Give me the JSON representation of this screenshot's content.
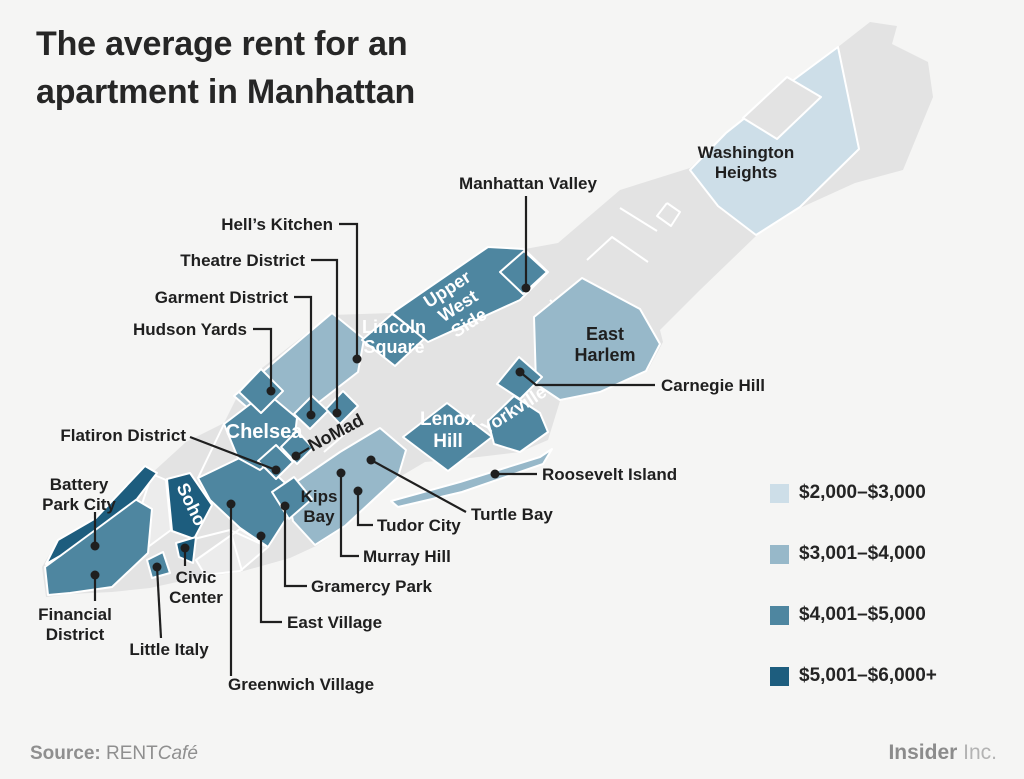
{
  "title": "The average rent for an apartment in Manhattan",
  "legend": {
    "items": [
      {
        "label": "$2,000–$3,000",
        "color": "#cddee8"
      },
      {
        "label": "$3,001–$4,000",
        "color": "#97b8c9"
      },
      {
        "label": "$4,001–$5,000",
        "color": "#4e86a0"
      },
      {
        "label": "$5,001–$6,000+",
        "color": "#1d5d7e"
      }
    ]
  },
  "map": {
    "colors": {
      "background": "#f5f5f4",
      "base_gray": "#e3e3e3",
      "light_gray": "#ececec",
      "border": "#ffffff",
      "callout": "#1f1f1f"
    },
    "regions": [
      {
        "id": "washington-heights",
        "tier": 0
      },
      {
        "id": "hells-kitchen-band",
        "tier": 1
      },
      {
        "id": "east-side-band",
        "tier": 1
      },
      {
        "id": "east-harlem",
        "tier": 1
      },
      {
        "id": "roosevelt-island",
        "tier": 1
      },
      {
        "id": "financial-district",
        "tier": 2
      },
      {
        "id": "village-band",
        "tier": 2
      },
      {
        "id": "gramercy",
        "tier": 2
      },
      {
        "id": "little-italy",
        "tier": 2
      },
      {
        "id": "chelsea",
        "tier": 2
      },
      {
        "id": "hudson-yards",
        "tier": 2
      },
      {
        "id": "garment",
        "tier": 2
      },
      {
        "id": "theatre",
        "tier": 2
      },
      {
        "id": "flatiron",
        "tier": 2
      },
      {
        "id": "nomad",
        "tier": 2
      },
      {
        "id": "lincoln-square",
        "tier": 2
      },
      {
        "id": "uws-band",
        "tier": 2
      },
      {
        "id": "manhattan-valley",
        "tier": 2
      },
      {
        "id": "lenox-hill",
        "tier": 2
      },
      {
        "id": "yorkville",
        "tier": 2
      },
      {
        "id": "carnegie-hill",
        "tier": 2
      },
      {
        "id": "battery-park-city",
        "tier": 3
      },
      {
        "id": "soho",
        "tier": 3
      },
      {
        "id": "civic-center",
        "tier": 3
      }
    ],
    "labels": [
      {
        "id": "manhattan-valley",
        "label": "Manhattan Valley"
      },
      {
        "id": "hells-kitchen",
        "label": "Hell’s Kitchen"
      },
      {
        "id": "theatre-district",
        "label": "Theatre District"
      },
      {
        "id": "garment-district",
        "label": "Garment District"
      },
      {
        "id": "hudson-yards",
        "label": "Hudson Yards"
      },
      {
        "id": "carnegie-hill",
        "label": "Carnegie Hill"
      },
      {
        "id": "flatiron-district",
        "label": "Flatiron District"
      },
      {
        "id": "battery-park-city",
        "label": "Battery Park City"
      },
      {
        "id": "financial-district",
        "label": "Financial District"
      },
      {
        "id": "civic-center",
        "label": "Civic Center"
      },
      {
        "id": "little-italy",
        "label": "Little Italy"
      },
      {
        "id": "greenwich-village",
        "label": "Greenwich Village"
      },
      {
        "id": "east-village",
        "label": "East Village"
      },
      {
        "id": "gramercy-park",
        "label": "Gramercy Park"
      },
      {
        "id": "murray-hill",
        "label": "Murray Hill"
      },
      {
        "id": "tudor-city",
        "label": "Tudor City"
      },
      {
        "id": "turtle-bay",
        "label": "Turtle Bay"
      },
      {
        "id": "roosevelt-island",
        "label": "Roosevelt Island"
      },
      {
        "id": "washington-heights",
        "label": "Washington Heights"
      },
      {
        "id": "east-harlem",
        "label": "East Harlem"
      },
      {
        "id": "kips-bay",
        "label": "Kips Bay"
      },
      {
        "id": "nomad",
        "label": "NoMad"
      },
      {
        "id": "chelsea",
        "label": "Chelsea"
      },
      {
        "id": "lincoln-square",
        "label": "Lincoln Square"
      },
      {
        "id": "upper-west-side",
        "label": "Upper West Side"
      },
      {
        "id": "lenox-hill",
        "label": "Lenox Hill"
      },
      {
        "id": "yorkville",
        "label": "Yorkville"
      },
      {
        "id": "soho",
        "label": "Soho"
      }
    ]
  },
  "footer": {
    "source_prefix": "Source:",
    "source_name": "RENT",
    "source_name_italic": "Café",
    "brand": "Insider",
    "brand_suffix": "Inc."
  }
}
